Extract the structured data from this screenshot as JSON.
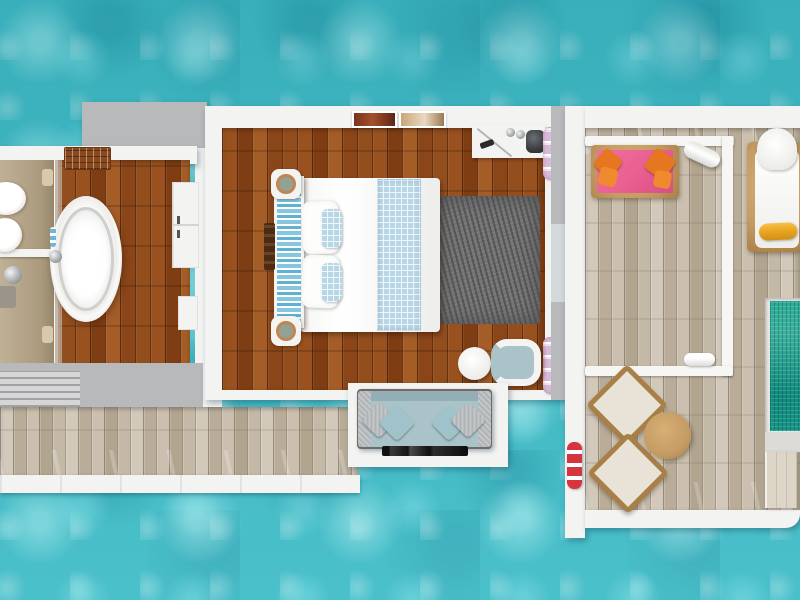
{
  "scene": {
    "description": "Top-down 3D rendered floor plan of an overwater villa suite surrounded by turquoise sea",
    "view": "top-down",
    "areas": [
      {
        "name": "bathroom",
        "items": [
          "washbasin",
          "toilet",
          "shower-fixture",
          "glass-partition",
          "freestanding-bathtub",
          "bathtub-faucet",
          "wall-cabinet",
          "storage-box",
          "towel-rack",
          "louvered-vent"
        ]
      },
      {
        "name": "bedroom",
        "items": [
          "double-bed",
          "patterned-headboard-bench",
          "bedpost-knobs",
          "white-pillows",
          "blue-accent-pillows",
          "checkered-runner",
          "luggage-rack",
          "wall-art-frame-red",
          "wall-art-frame-tan",
          "minibar-counter",
          "coffee-cups",
          "kettle",
          "remote",
          "towel-shelf-top",
          "towel-shelf-bottom",
          "area-rug",
          "round-side-table",
          "barrel-armchair",
          "sofa",
          "sofa-pillows",
          "wall-tv"
        ]
      },
      {
        "name": "sun-deck",
        "items": [
          "pink-daybed",
          "orange-bolster-pillows",
          "rolled-towel",
          "sun-lounger",
          "yellow-bolster-pillow",
          "square-lounge-chair",
          "square-lounge-chair",
          "round-coffee-table",
          "deck-towel",
          "plunge-pool",
          "pool-step-box",
          "red-striped-towel-roll",
          "white-railing",
          "roof-beam"
        ]
      },
      {
        "name": "walkway-deck",
        "items": [
          "plank-walkway",
          "white-fascia-edge"
        ]
      }
    ]
  },
  "colors": {
    "water": "#3fbcc7",
    "pool": "#1ba690",
    "poolDark": "#0f8a7e",
    "woodA": "#99521f",
    "woodB": "#7e3d13",
    "woodC": "#a55d28",
    "woodD": "#8a4518",
    "deckA": "#d2c9bb",
    "deckB": "#b9ad99",
    "deckC": "#cbc0af",
    "deckD": "#b1a590",
    "white": "#f3f3f2",
    "gray": "#b8b9bb",
    "lilac": "#d9bad8",
    "pink": "#e95f90",
    "orange": "#e6761f",
    "yellow": "#eca825",
    "tan": "#c59c63",
    "tanDark": "#a97f48",
    "red": "#d6353f",
    "sofa": "#a9c3c9",
    "pillowGray": "#b0b4b6",
    "bedBlue": "#86c6de",
    "checkBlue": "#b7d6e6",
    "rug": "#747474",
    "rugDark": "#4e4e4e"
  }
}
